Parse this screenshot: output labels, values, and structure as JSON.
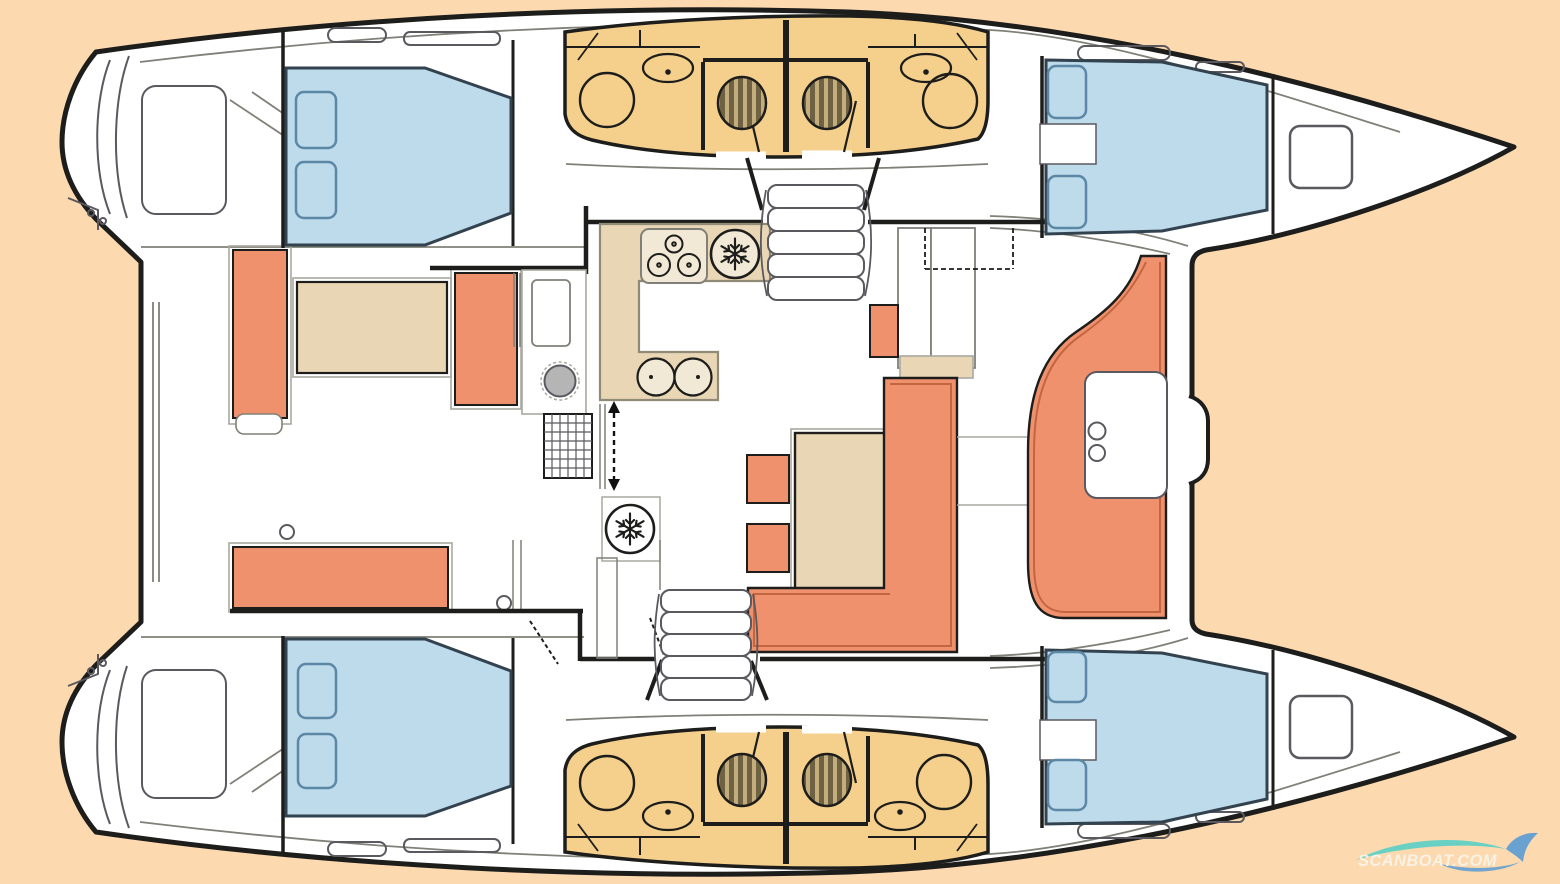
{
  "watermark": {
    "text": "SCANBOAT.COM"
  },
  "colors": {
    "background": "#fcd9af",
    "hull": "#ffffff",
    "outline": "#1d1d1b",
    "line_gray": "#59595f",
    "light_gray": "#a8a8a0",
    "mid_gray": "#808078",
    "bed_blue": "#bddbeb",
    "bed_outline": "#33424f",
    "pillow_outline": "#5c88a6",
    "orange": "#f0916e",
    "orange_dark": "#c2663f",
    "tan": "#e9d6b5",
    "tan_dark": "#8f8b76",
    "panel_cream": "#f1e9d6",
    "bath_yellow": "#f5d08c",
    "toilet_dark": "#6f6243",
    "toilet_light": "#c4ad7c",
    "steel": "#b5b5b5",
    "arrow_black": "#111111",
    "wm_text": "#f8f4ea",
    "wm_teal": "#58cfc6",
    "wm_blue": "#4f97d6"
  },
  "icons": {
    "fridge_icon": "snowflake-in-circle",
    "stove_icon": "three-burner-hob",
    "sink_icon": "oval-basin-with-tap",
    "galley_sink_icon": "twin-round-basins",
    "toilet_icon": "striped-round-wc",
    "shower_icon": "round-shower-stall",
    "stairs_icon": "tread-stack",
    "sliding_door_icon": "dashed-double-arrow",
    "watermark_wave_icon": "wave-swoosh"
  }
}
